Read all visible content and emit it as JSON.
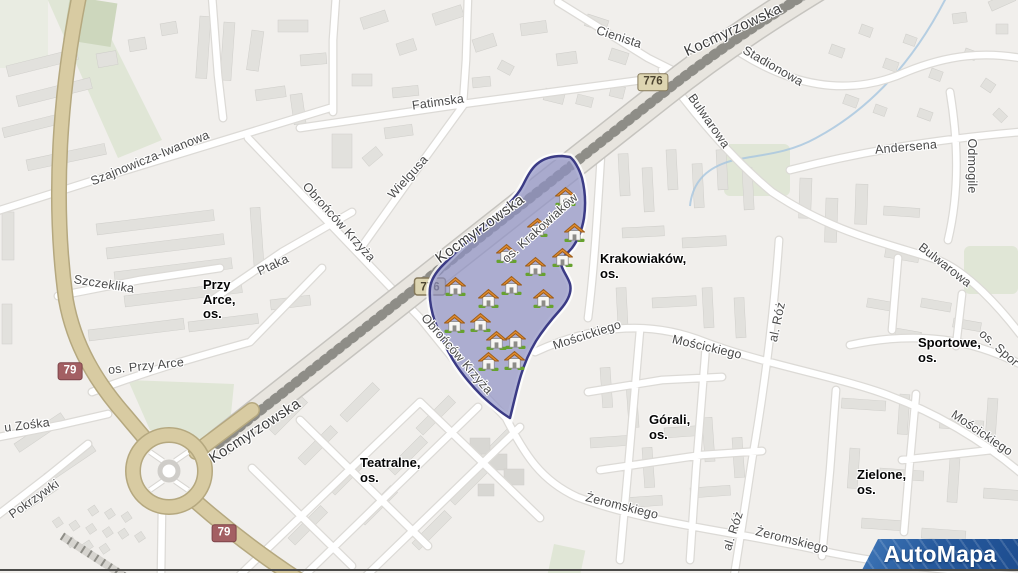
{
  "map": {
    "street_labels": [
      {
        "text": "Kocmyrzowska",
        "x": 733,
        "y": 30,
        "rot": -25,
        "major": true
      },
      {
        "text": "Kocmyrzowska",
        "x": 480,
        "y": 229,
        "rot": -36,
        "major": true
      },
      {
        "text": "Kocmyrzowska",
        "x": 255,
        "y": 431,
        "rot": -33,
        "major": true
      },
      {
        "text": "Szajnowicza-Iwanowa",
        "x": 150,
        "y": 158,
        "rot": -22
      },
      {
        "text": "Fatimska",
        "x": 438,
        "y": 102,
        "rot": -8
      },
      {
        "text": "Wielgusa",
        "x": 408,
        "y": 177,
        "rot": -48
      },
      {
        "text": "Cienista",
        "x": 619,
        "y": 37,
        "rot": 18
      },
      {
        "text": "Stadionowa",
        "x": 773,
        "y": 66,
        "rot": 30
      },
      {
        "text": "Bulwarowa",
        "x": 709,
        "y": 121,
        "rot": 55
      },
      {
        "text": "Bulwarowa",
        "x": 945,
        "y": 265,
        "rot": 38
      },
      {
        "text": "Andersena",
        "x": 906,
        "y": 147,
        "rot": -5
      },
      {
        "text": "Odmogile",
        "x": 972,
        "y": 166,
        "rot": 90
      },
      {
        "text": "Obrońców Krzyża",
        "x": 339,
        "y": 222,
        "rot": 48
      },
      {
        "text": "Obrońców Krzyża",
        "x": 457,
        "y": 354,
        "rot": 49
      },
      {
        "text": "os. Krakowiaków",
        "x": 540,
        "y": 228,
        "rot": -42
      },
      {
        "text": "Mościckiego",
        "x": 587,
        "y": 335,
        "rot": -18
      },
      {
        "text": "Mościckiego",
        "x": 707,
        "y": 347,
        "rot": 13
      },
      {
        "text": "Mościckiego",
        "x": 982,
        "y": 433,
        "rot": 34
      },
      {
        "text": "al. Róż",
        "x": 777,
        "y": 322,
        "rot": -78
      },
      {
        "text": "al. Róż",
        "x": 733,
        "y": 531,
        "rot": -72
      },
      {
        "text": "Żeromskiego",
        "x": 622,
        "y": 506,
        "rot": 14
      },
      {
        "text": "Żeromskiego",
        "x": 792,
        "y": 540,
        "rot": 14
      },
      {
        "text": "Szczeklika",
        "x": 104,
        "y": 284,
        "rot": 9
      },
      {
        "text": "Ptaka",
        "x": 273,
        "y": 265,
        "rot": -25
      },
      {
        "text": "os. Przy Arce",
        "x": 146,
        "y": 366,
        "rot": -6
      },
      {
        "text": "u Zośka",
        "x": 27,
        "y": 425,
        "rot": -7
      },
      {
        "text": "Pokrzywki",
        "x": 34,
        "y": 499,
        "rot": -35
      },
      {
        "text": "os. Spor",
        "x": 999,
        "y": 348,
        "rot": 42
      }
    ],
    "district_labels": [
      {
        "lines": [
          "Przy",
          "Arce,",
          "os."
        ],
        "x": 203,
        "y": 278
      },
      {
        "lines": [
          "Krakowiaków,",
          "os."
        ],
        "x": 600,
        "y": 252
      },
      {
        "lines": [
          "Sportowe,",
          "os."
        ],
        "x": 918,
        "y": 336
      },
      {
        "lines": [
          "Teatralne,",
          "os."
        ],
        "x": 360,
        "y": 456
      },
      {
        "lines": [
          "Górali,",
          "os."
        ],
        "x": 649,
        "y": 413
      },
      {
        "lines": [
          "Zielone,",
          "os."
        ],
        "x": 857,
        "y": 468
      }
    ],
    "road_badges": [
      {
        "text": "776",
        "x": 653,
        "y": 82,
        "style": "regional"
      },
      {
        "text": "776",
        "x": 430,
        "y": 287,
        "style": "regional",
        "layer": "svg"
      },
      {
        "text": "79",
        "x": 70,
        "y": 371,
        "style": "national"
      },
      {
        "text": "79",
        "x": 224,
        "y": 533,
        "style": "national"
      }
    ],
    "house_markers": [
      [
        565,
        197
      ],
      [
        537,
        228
      ],
      [
        574,
        233
      ],
      [
        506,
        254
      ],
      [
        562,
        258
      ],
      [
        535,
        267
      ],
      [
        455,
        287
      ],
      [
        511,
        286
      ],
      [
        488,
        299
      ],
      [
        543,
        299
      ],
      [
        454,
        324
      ],
      [
        480,
        323
      ],
      [
        496,
        341
      ],
      [
        515,
        340
      ],
      [
        488,
        362
      ],
      [
        514,
        361
      ]
    ],
    "colors": {
      "region_fill": "#8f92c4",
      "region_stroke": "#3b3b85",
      "badge_regional_bg": "#ddd5b1",
      "badge_national_bg": "#a35f63",
      "primary_road": "#d8cba2",
      "logo_blue": "#1d4d90"
    },
    "logo": {
      "text": "AutoMapa"
    }
  }
}
